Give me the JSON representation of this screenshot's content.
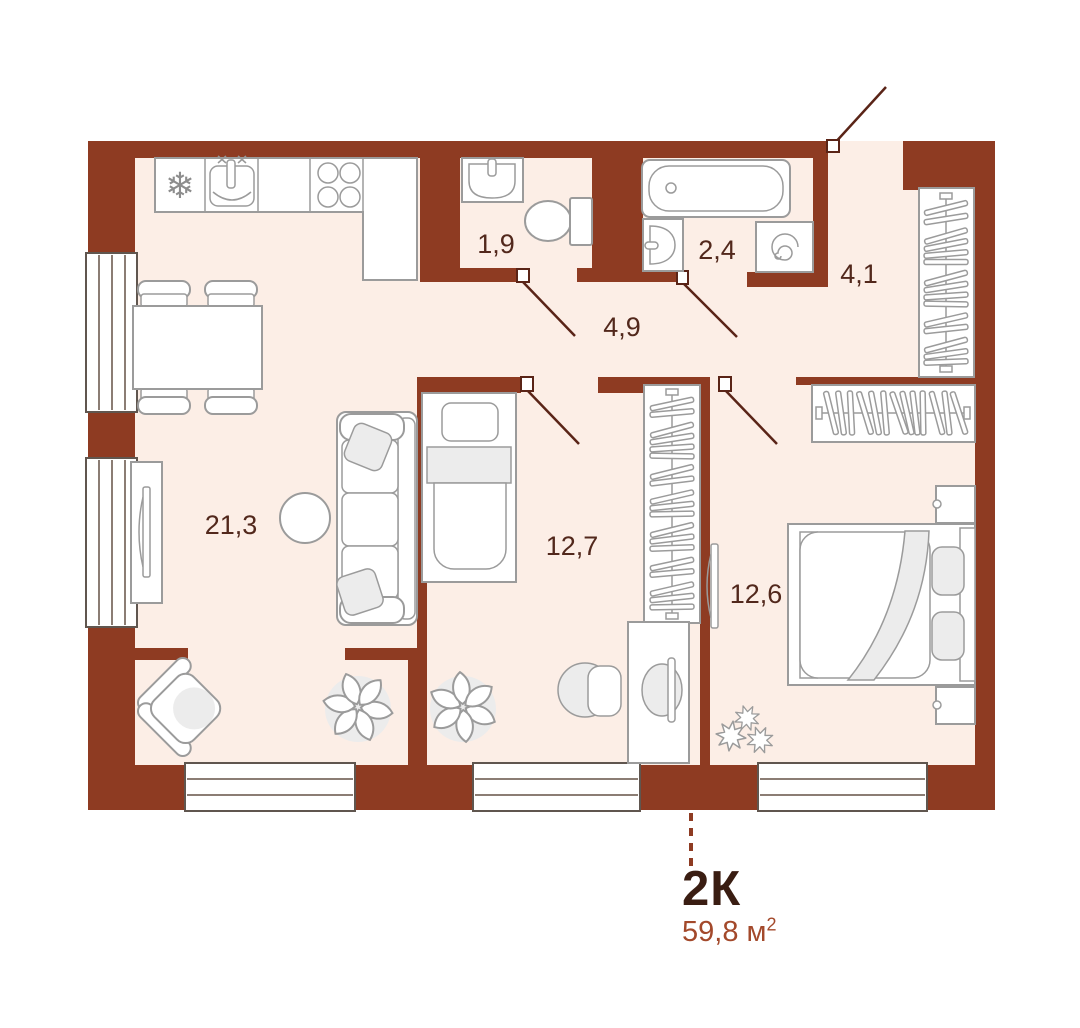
{
  "title": "Apartment floor plan",
  "colors": {
    "background": "#FFFFFF",
    "wall": "#8E3B22",
    "floor": "#FCEEE6",
    "outline": "#9B9B9B",
    "shade": "#ECECEC",
    "window_frame": "#60564F",
    "swing": "#5A2417",
    "room_label": "#52281C",
    "unit_type": "#3A1D12",
    "unit_area": "#A3492B"
  },
  "unit": {
    "type": "2К",
    "area_value": "59,8 м",
    "area_sup": "2"
  },
  "rooms": [
    {
      "name": "kitchen-living-room",
      "area": "21,3"
    },
    {
      "name": "bedroom-1",
      "area": "12,7"
    },
    {
      "name": "bedroom-2",
      "area": "12,6"
    },
    {
      "name": "hallway",
      "area": "4,9"
    },
    {
      "name": "entry-hall",
      "area": "4,1"
    },
    {
      "name": "wc",
      "area": "1,9"
    },
    {
      "name": "bathroom",
      "area": "2,4"
    }
  ],
  "icons": {
    "fridge_snowflake": "❄"
  },
  "furniture": [
    "fridge",
    "kitchen-sink",
    "stove",
    "kitchen-counter",
    "dining-table",
    "dining-chairs",
    "sofa",
    "coffee-table",
    "tv-stand",
    "tv",
    "armchair",
    "plant",
    "single-bed",
    "wardrobe",
    "desk",
    "desk-chair",
    "double-bed",
    "nightstand",
    "wc-sink",
    "toilet",
    "bathtub",
    "bath-sink",
    "washing-machine",
    "entrance-door",
    "interior-door",
    "window"
  ]
}
